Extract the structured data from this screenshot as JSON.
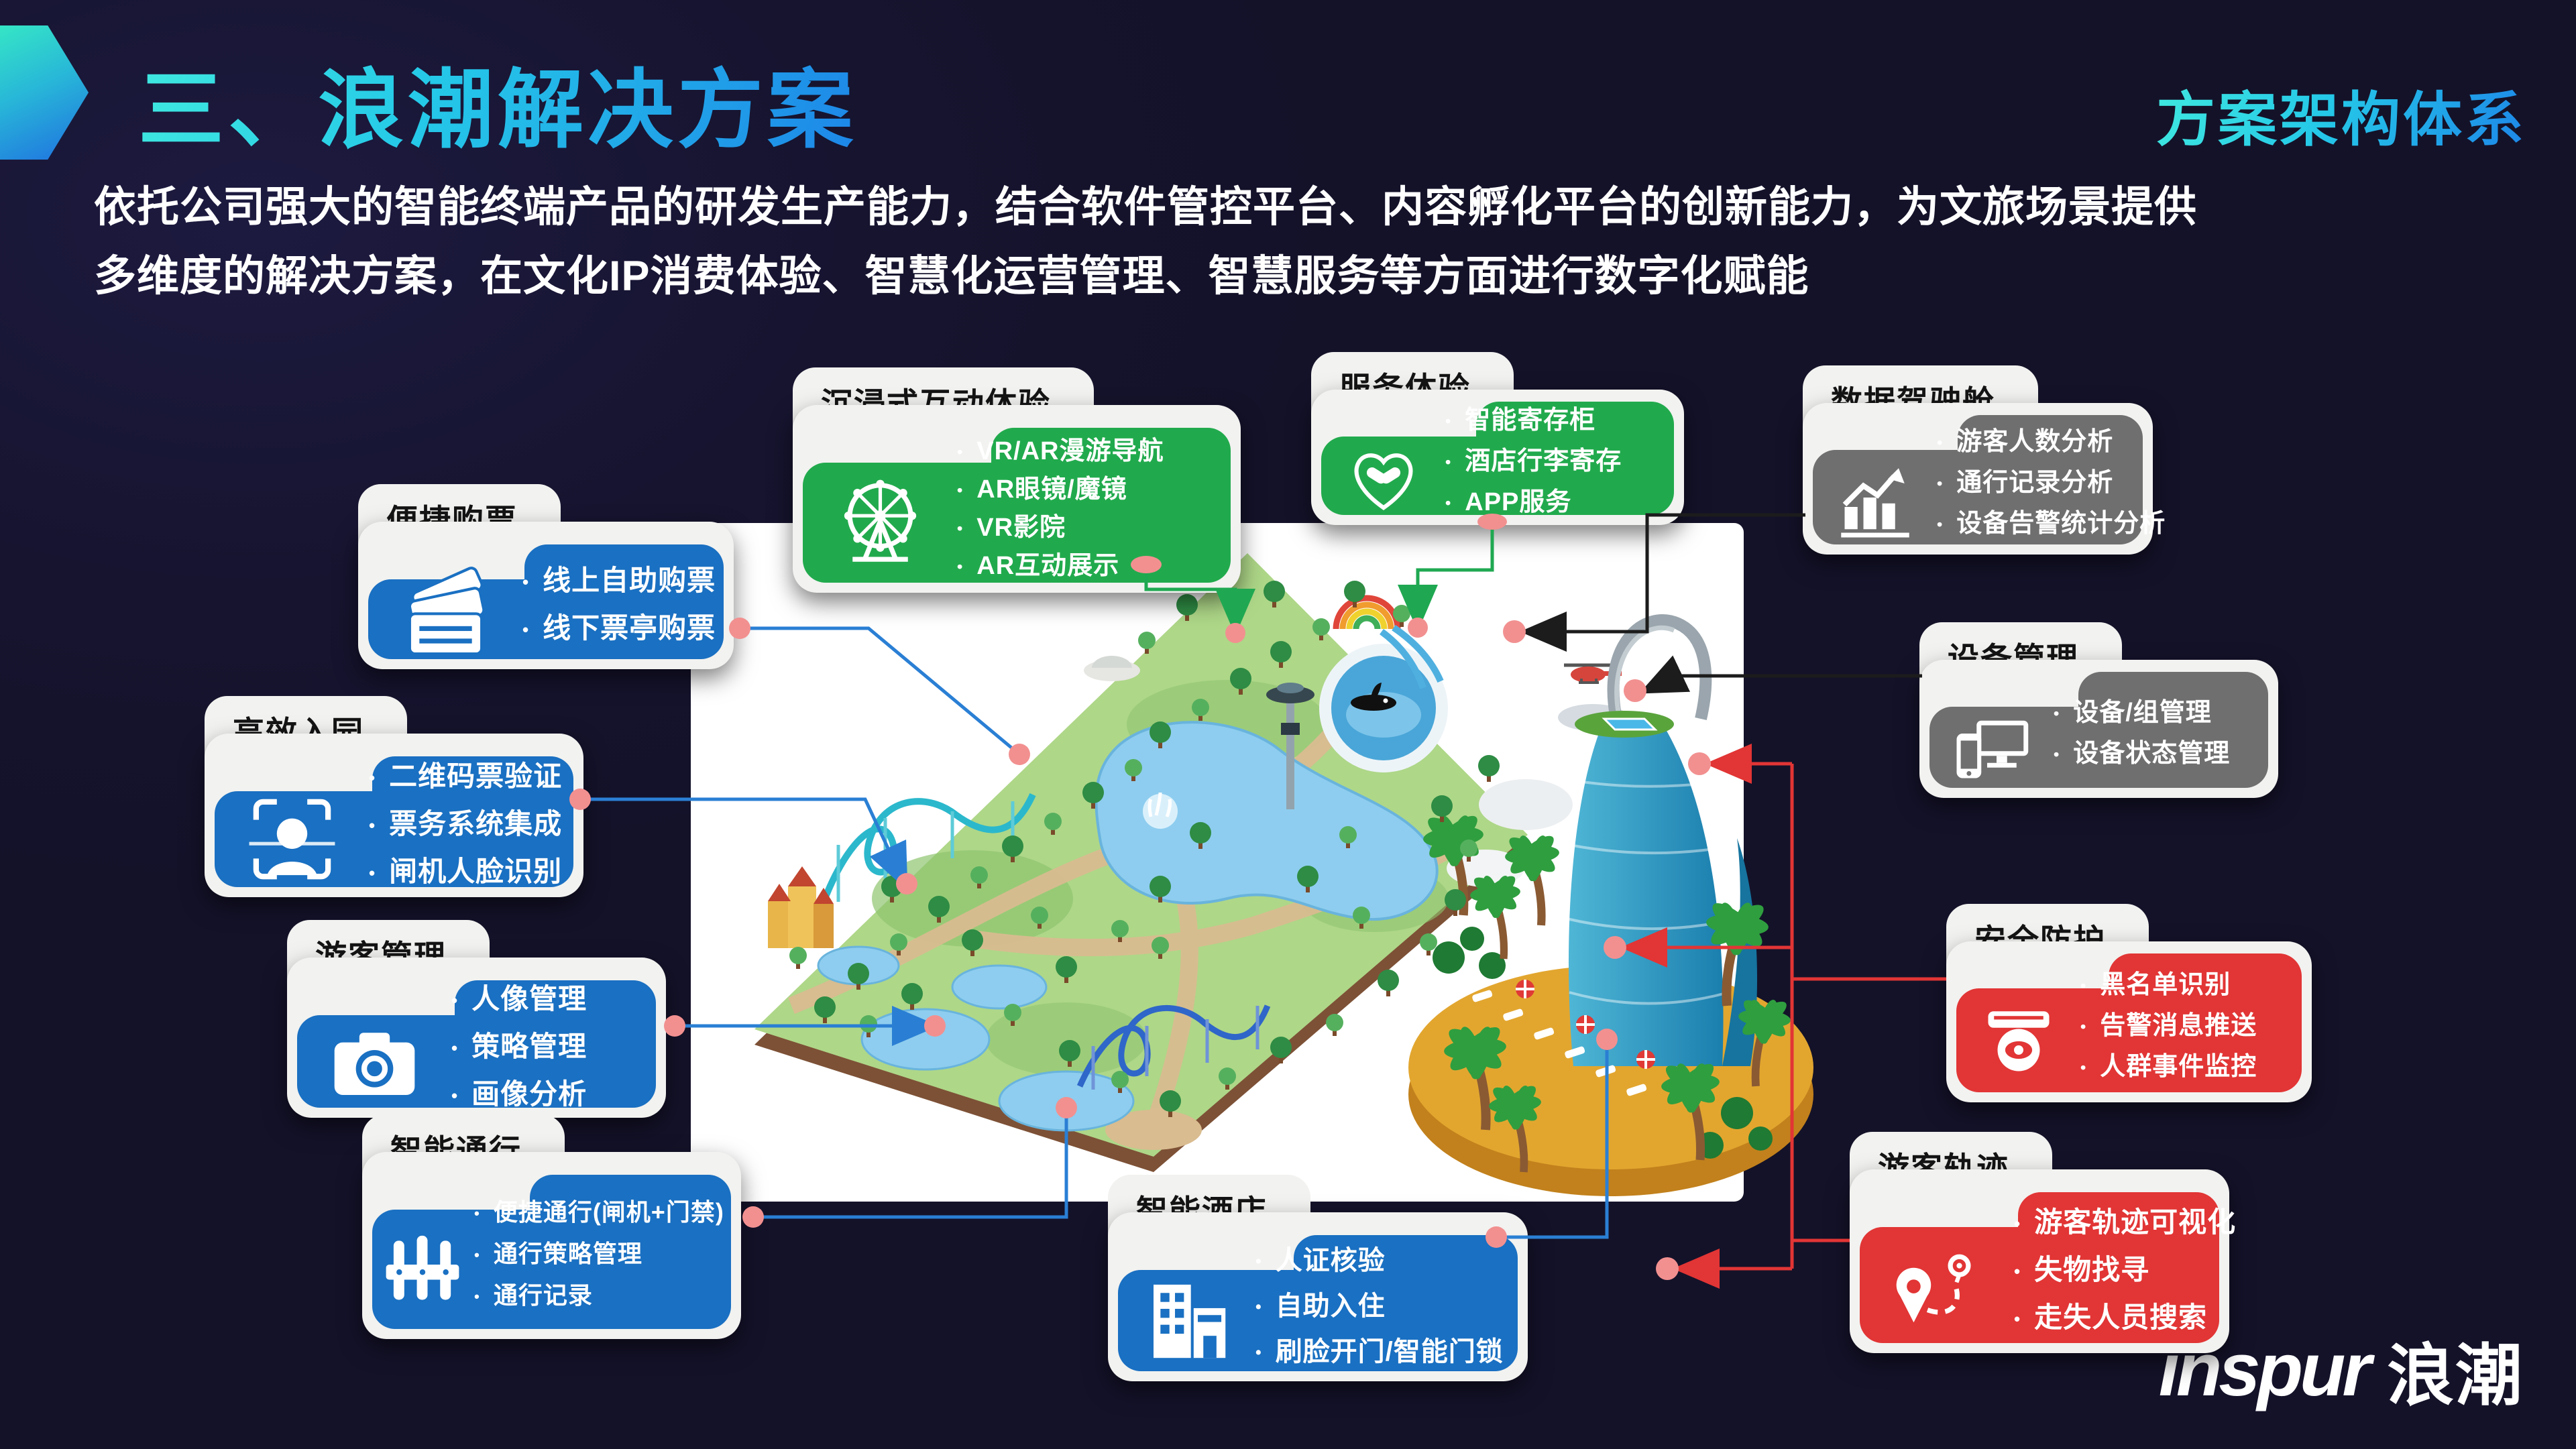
{
  "slide": {
    "title": "三、浪潮解决方案",
    "corner_tag": "方案架构体系",
    "desc1": "依托公司强大的智能终端产品的研发生产能力，结合软件管控平台、内容孵化平台的创新能力，为文旅场景提供",
    "desc2": "多维度的解决方案，在文化IP消费体验、智慧化运营管理、智慧服务等方面进行数字化赋能",
    "logo_en": "inspur",
    "logo_cn": "浪潮"
  },
  "colors": {
    "background": "#16142f",
    "card_blue": "#1a70c2",
    "card_green": "#21aa4d",
    "card_gray": "#6f6f6f",
    "card_red": "#e23535",
    "accent_cyan": "#2bd9e8",
    "connector_dot": "#f29090"
  },
  "cards": [
    {
      "id": "ticketing",
      "title": "便捷购票",
      "color": "blue",
      "icon": "tickets-icon",
      "items": [
        "线上自助购票",
        "线下票亭购票"
      ]
    },
    {
      "id": "entry",
      "title": "高效入园",
      "color": "blue",
      "icon": "face-scan-icon",
      "items": [
        "二维码票验证",
        "票务系统集成",
        "闸机人脸识别"
      ]
    },
    {
      "id": "visitor-mgmt",
      "title": "游客管理",
      "color": "blue",
      "icon": "camera-icon",
      "items": [
        "人像管理",
        "策略管理",
        "画像分析"
      ]
    },
    {
      "id": "smart-pass",
      "title": "智能通行",
      "color": "blue",
      "icon": "gate-icon",
      "items": [
        "便捷通行(闸机+门禁)",
        "通行策略管理",
        "通行记录"
      ]
    },
    {
      "id": "immersive",
      "title": "沉浸式互动体验",
      "color": "green",
      "icon": "ferris-wheel-icon",
      "items": [
        "VR/AR漫游导航",
        "AR眼镜/魔镜",
        "VR影院",
        "AR互动展示"
      ]
    },
    {
      "id": "service",
      "title": "服务体验",
      "color": "green",
      "icon": "handshake-heart-icon",
      "items": [
        "智能寄存柜",
        "酒店行李寄存",
        "APP服务"
      ]
    },
    {
      "id": "data-cockpit",
      "title": "数据驾驶舱",
      "color": "gray",
      "icon": "trend-chart-icon",
      "items": [
        "游客人数分析",
        "通行记录分析",
        "设备告警统计分析"
      ]
    },
    {
      "id": "device-mgmt",
      "title": "设备管理",
      "color": "gray",
      "icon": "devices-icon",
      "items": [
        "设备/组管理",
        "设备状态管理"
      ]
    },
    {
      "id": "security",
      "title": "安全防护",
      "color": "red",
      "icon": "cctv-icon",
      "items": [
        "黑名单识别",
        "告警消息推送",
        "人群事件监控"
      ]
    },
    {
      "id": "visitor-track",
      "title": "游客轨迹",
      "color": "red",
      "icon": "route-icon",
      "items": [
        "游客轨迹可视化",
        "失物找寻",
        "走失人员搜索"
      ]
    },
    {
      "id": "smart-hotel",
      "title": "智能酒店",
      "color": "blue",
      "icon": "hotel-icon",
      "items": [
        "人证核验",
        "自助入住",
        "刷脸开门/智能门锁"
      ]
    }
  ]
}
